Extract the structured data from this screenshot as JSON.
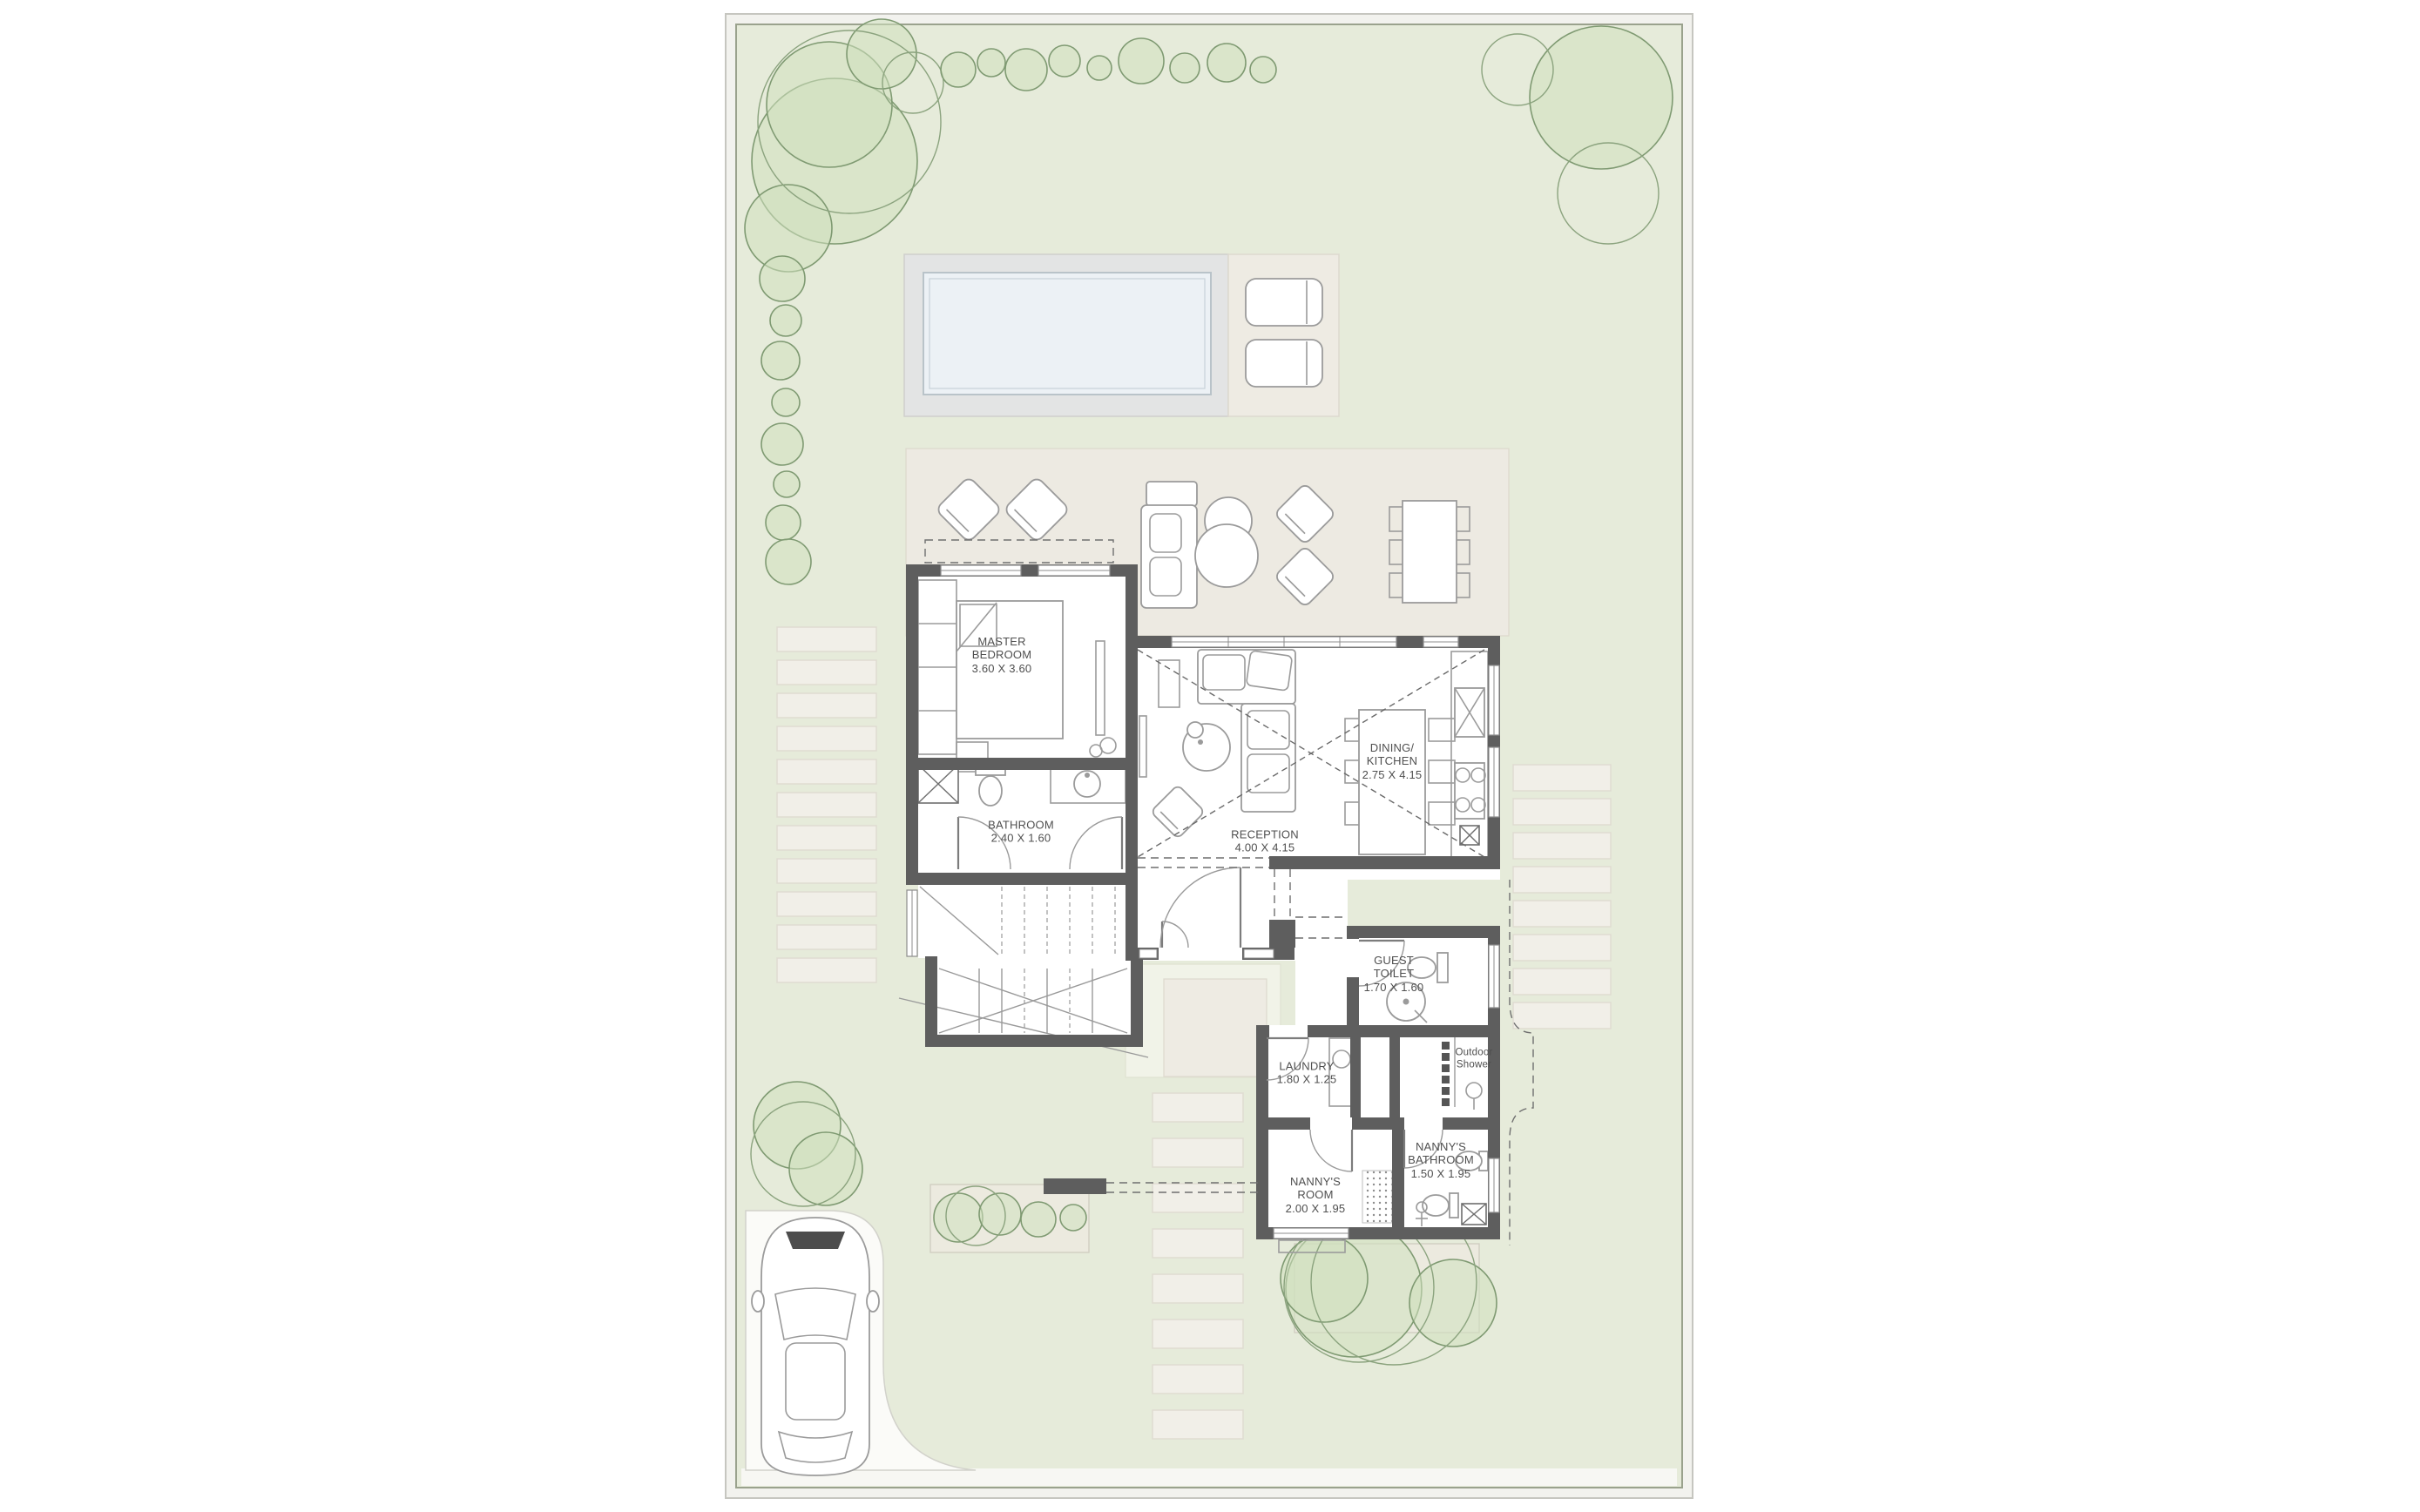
{
  "rooms": {
    "master_bedroom": {
      "name": "MASTER BEDROOM",
      "dims": "3.60 X 3.60"
    },
    "bathroom": {
      "name": "BATHROOM",
      "dims": "2.40 X 1.60"
    },
    "reception": {
      "name": "RECEPTION",
      "dims": "4.00 X 4.15"
    },
    "dining_kitchen": {
      "name": "DINING/ KITCHEN",
      "dims": "2.75 X 4.15"
    },
    "guest_toilet": {
      "name": "GUEST TOILET",
      "dims": "1.70 X 1.60"
    },
    "laundry": {
      "name": "LAUNDRY",
      "dims": "1.80 X 1.25"
    },
    "outdoor_shower": {
      "name": "Outdoor Shower",
      "dims": ""
    },
    "nannys_room": {
      "name": "NANNY'S ROOM",
      "dims": "2.00 X 1.95"
    },
    "nannys_bathroom": {
      "name": "NANNY'S BATHROOM",
      "dims": "1.50 X 1.95"
    }
  },
  "icons": [
    "tree-icon",
    "shrub-icon",
    "stepping-stone-icon",
    "pool-icon",
    "sun-lounger-icon",
    "armchair-icon",
    "sofa-icon",
    "coffee-table-icon",
    "dining-table-icon",
    "chair-icon",
    "bed-icon",
    "wardrobe-icon",
    "tv-console-icon",
    "toilet-icon",
    "sink-icon",
    "kitchen-sink-icon",
    "stove-icon",
    "counter-icon",
    "washer-icon",
    "shower-head-icon",
    "stair-icon",
    "double-door-icon",
    "single-door-icon",
    "window-icon",
    "shaft-icon",
    "person-icon",
    "car-icon",
    "garden-wall-icon",
    "rug-icon"
  ],
  "colors": {
    "plot": "#e6ebda",
    "terrace": "#edeae2",
    "stone": "#f1efe8",
    "deck": "#e3e4e4",
    "water": "#ecf1f5",
    "wall": "#5e5e5e",
    "tree": "#cfe0bd",
    "ink": "#4f4f4f"
  }
}
